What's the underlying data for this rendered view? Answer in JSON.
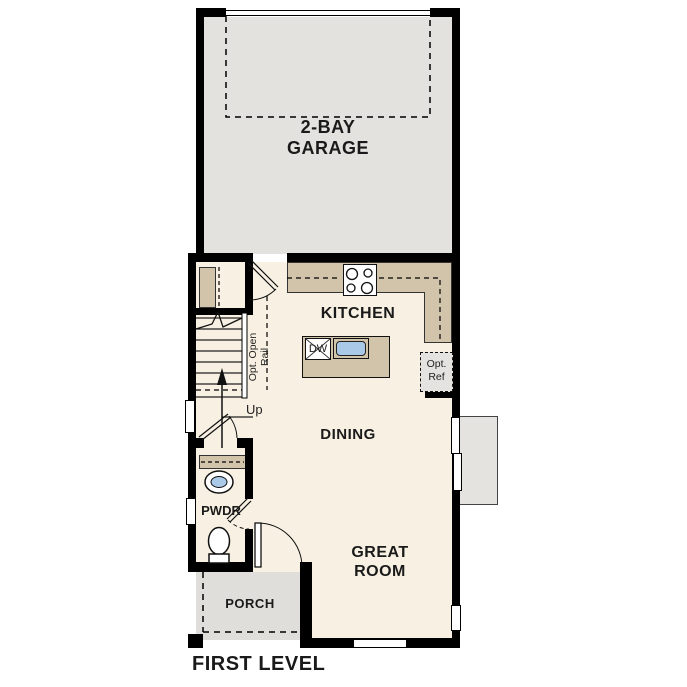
{
  "plan": {
    "title": "FIRST LEVEL",
    "rooms": {
      "garage": {
        "name_line1": "2-BAY",
        "name_line2": "GARAGE"
      },
      "kitchen": {
        "name": "KITCHEN"
      },
      "dining": {
        "name": "DINING"
      },
      "great_room": {
        "name_line1": "GREAT",
        "name_line2": "ROOM"
      },
      "powder": {
        "name": "PWDR"
      },
      "porch": {
        "name": "PORCH"
      }
    },
    "annotations": {
      "stairs_direction": "Up",
      "opt_rail_line1": "Opt. Open",
      "opt_rail_line2": "Rail",
      "dishwasher": "DW",
      "opt_ref_line1": "Opt.",
      "opt_ref_line2": "Ref"
    },
    "colors": {
      "wall": "#000000",
      "interior_floor": "#f8f1e3",
      "garage_floor": "#e3e2de",
      "porch_floor": "#dfdeda",
      "patio_floor": "#e4e3e0",
      "counter": "#d1c4aa",
      "sink_fill": "#aac9e8",
      "label_text": "#1a1a1a"
    }
  }
}
